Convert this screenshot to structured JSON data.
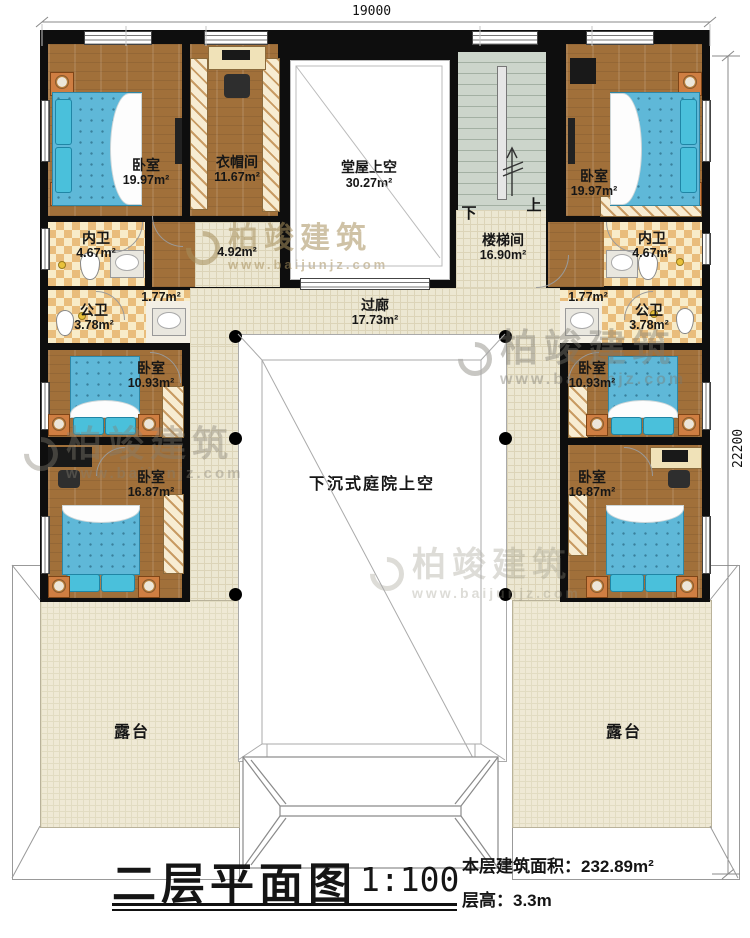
{
  "dimensions": {
    "top": "19000",
    "right": "22200"
  },
  "rooms": {
    "bedroom_tl": {
      "name": "卧室",
      "area": "19.97m²"
    },
    "closet": {
      "name": "衣帽间",
      "area": "11.67m²"
    },
    "hall_void": {
      "name": "堂屋上空",
      "area": "30.27m²"
    },
    "stairwell": {
      "name": "楼梯间",
      "area": "16.90m²"
    },
    "bedroom_tr": {
      "name": "卧室",
      "area": "19.97m²"
    },
    "bath_l": {
      "name": "内卫",
      "area": "4.67m²"
    },
    "bath_r": {
      "name": "内卫",
      "area": "4.67m²"
    },
    "hall_small": {
      "area": "4.92m²"
    },
    "niche_l": {
      "area": "1.77m²"
    },
    "niche_r": {
      "area": "1.77m²"
    },
    "pubbath_l": {
      "name": "公卫",
      "area": "3.78m²"
    },
    "pubbath_r": {
      "name": "公卫",
      "area": "3.78m²"
    },
    "corridor": {
      "name": "过廊",
      "area": "17.73m²"
    },
    "bedroom_ml": {
      "name": "卧室",
      "area": "10.93m²"
    },
    "bedroom_mr": {
      "name": "卧室",
      "area": "10.93m²"
    },
    "bedroom_bl": {
      "name": "卧室",
      "area": "16.87m²"
    },
    "bedroom_br": {
      "name": "卧室",
      "area": "16.87m²"
    },
    "courtyard": {
      "name": "下沉式庭院上空"
    },
    "terrace_l": {
      "name": "露台"
    },
    "terrace_r": {
      "name": "露台"
    }
  },
  "stairs": {
    "down": "下",
    "up": "上"
  },
  "title": {
    "name": "二层平面图",
    "scale": "1:100",
    "floor_area": "本层建筑面积：232.89m²",
    "floor_height": "层高：3.3m"
  },
  "watermark": {
    "brand": "柏竣建筑",
    "url": "www.baijunjz.com"
  }
}
